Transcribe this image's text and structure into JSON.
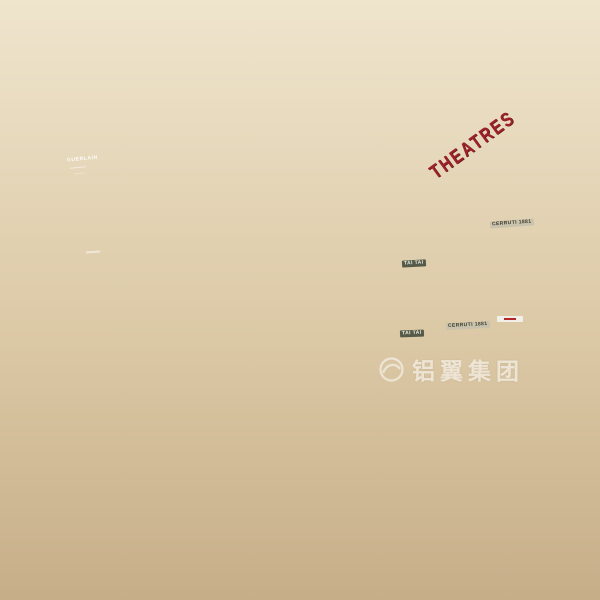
{
  "signs": {
    "theatres": "THEATRES",
    "tai_tai_upper": "TAI TAI",
    "tai_tai_lower": "TAI TAI",
    "cerruti_upper": "CERRUTI 1881",
    "cerruti_lower": "CERRUTI 1881"
  },
  "ad_screen": {
    "brand": "GUERLAIN"
  },
  "watermark": {
    "text": "铝翼集团"
  },
  "palette": {
    "sky": "#191230",
    "beam": "#cfcedd",
    "fascia_cream": "#f3ecdd",
    "led_white": "#fffdf2",
    "wood": "#c59a5f",
    "handrail_wood": "#b5773b",
    "glow_wall_amber": "#f6d29a",
    "theatre_red": "#ab2029",
    "floor_beige": "#e6d9bd",
    "tree_green": "#22402a"
  },
  "crowd": [
    [
      88,
      562,
      "#3a4a6b"
    ],
    [
      101,
      563,
      "#b43a3a"
    ],
    [
      128,
      557,
      "#2f2f38"
    ],
    [
      191,
      541,
      "#7a5fa0"
    ],
    [
      205,
      540,
      "#f2f2f2"
    ],
    [
      223,
      541,
      "#3f7f74"
    ],
    [
      270,
      522,
      "#3a4a6b"
    ],
    [
      291,
      523,
      "#d98fa6"
    ],
    [
      358,
      581,
      "#4f86c6",
      0.85
    ],
    [
      374,
      580,
      "#e8e8e8",
      0.85
    ],
    [
      372,
      559,
      "#f2f2f2",
      0.9
    ],
    [
      388,
      557,
      "#3a4a6b",
      0.9
    ],
    [
      403,
      558,
      "#b43a3a",
      0.9
    ],
    [
      418,
      557,
      "#222a44",
      0.9
    ],
    [
      462,
      517,
      "#8c4a32",
      0.85
    ],
    [
      478,
      513,
      "#3a4a6b",
      0.85
    ],
    [
      493,
      512,
      "#f2f2f2",
      0.85
    ],
    [
      511,
      514,
      "#222a44",
      0.85
    ],
    [
      536,
      541,
      "#7a5fa0",
      0.8
    ],
    [
      552,
      539,
      "#2f2f38",
      0.8
    ],
    [
      570,
      541,
      "#4f86c6",
      0.8
    ],
    [
      588,
      539,
      "#8c4a32",
      0.8
    ],
    [
      118,
      591,
      "#3f7f74"
    ],
    [
      142,
      589,
      "#b43a3a"
    ],
    [
      210,
      572,
      "#3a4a6b"
    ],
    [
      40,
      379,
      "#f2f2f2",
      0.8
    ],
    [
      57,
      376,
      "#3a4a6b",
      0.8
    ],
    [
      70,
      375,
      "#b43a3a",
      0.8
    ],
    [
      104,
      369,
      "#7a5fa0",
      0.8
    ],
    [
      126,
      365,
      "#f2f2f2",
      0.8
    ],
    [
      148,
      361,
      "#3f7f74",
      0.8
    ],
    [
      310,
      304,
      "#3a4a6b",
      0.8
    ],
    [
      322,
      302,
      "#f2f2f2",
      0.8
    ],
    [
      342,
      300,
      "#b43a3a",
      0.8
    ],
    [
      356,
      298,
      "#3a4a6b",
      0.8
    ],
    [
      374,
      296,
      "#e8e8e8",
      0.8
    ],
    [
      452,
      282,
      "#4f86c6",
      0.8
    ],
    [
      464,
      280,
      "#222a44",
      0.8
    ],
    [
      502,
      270,
      "#d98fa6",
      0.8
    ],
    [
      528,
      264,
      "#3a4a6b",
      0.8
    ],
    [
      208,
      256,
      "#b43a3a",
      0.7
    ],
    [
      217,
      254,
      "#f2f2f2",
      0.7
    ],
    [
      384,
      202,
      "#3a4a6b",
      0.7
    ],
    [
      394,
      200,
      "#d98fa6",
      0.7
    ],
    [
      402,
      182,
      "#b43a3a",
      0.7
    ],
    [
      300,
      224,
      "#4f86c6",
      0.75
    ],
    [
      232,
      420,
      "#d98fa6",
      0.85
    ],
    [
      345,
      446,
      "#3a4a6b",
      0.85
    ],
    [
      360,
      443,
      "#b43a3a",
      0.85
    ],
    [
      468,
      482,
      "#8c4a32",
      0.9
    ],
    [
      483,
      485,
      "#b43a3a",
      0.9
    ],
    [
      505,
      476,
      "#2f2f38",
      0.9
    ],
    [
      519,
      474,
      "#3f7f74",
      0.9
    ],
    [
      545,
      531,
      "#f2f2f2",
      0.75
    ],
    [
      560,
      528,
      "#4f86c6",
      0.75
    ],
    [
      578,
      529,
      "#222a44",
      0.75
    ]
  ],
  "mannequins": [
    [
      280,
      428
    ],
    [
      292,
      427
    ],
    [
      304,
      426
    ],
    [
      500,
      316
    ],
    [
      512,
      314
    ]
  ],
  "ceiling_lights": [
    [
      45,
      42
    ],
    [
      93,
      14
    ],
    [
      128,
      96
    ],
    [
      165,
      63
    ],
    [
      217,
      32
    ],
    [
      287,
      90
    ],
    [
      300,
      18
    ],
    [
      338,
      58
    ],
    [
      388,
      6
    ],
    [
      410,
      86
    ],
    [
      438,
      84
    ],
    [
      460,
      36
    ],
    [
      512,
      58
    ],
    [
      140,
      120
    ],
    [
      205,
      136
    ],
    [
      262,
      150
    ]
  ],
  "sparkles": [
    [
      262,
      212
    ],
    [
      450,
      180
    ],
    [
      390,
      332
    ],
    [
      452,
      316
    ],
    [
      548,
      298
    ],
    [
      118,
      434
    ],
    [
      300,
      238
    ],
    [
      572,
      118
    ]
  ]
}
